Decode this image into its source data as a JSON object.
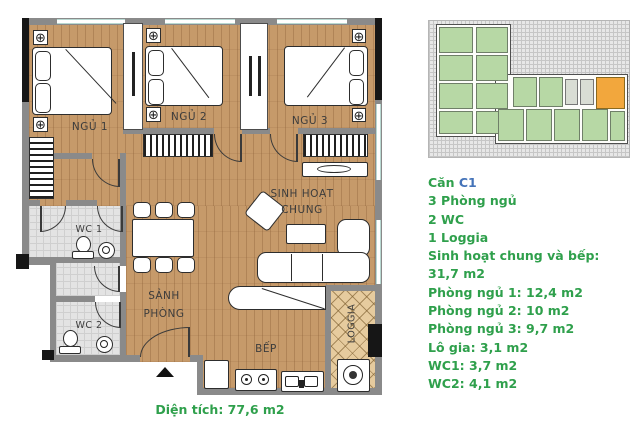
{
  "floor_plan": {
    "rooms": {
      "bedroom1": "NGỦ 1",
      "bedroom2": "NGỦ 2",
      "bedroom3": "NGỦ 3",
      "living_line1": "SINH HOẠT",
      "living_line2": "CHUNG",
      "wc1": "WC 1",
      "wc2": "WC 2",
      "hall_line1": "SẢNH",
      "hall_line2": "PHÒNG",
      "kitchen": "BẾP",
      "loggia": "LOGGIA"
    },
    "area_label": "Diện tích: 77,6 m2",
    "icons": {
      "corner_cross": "⊕"
    }
  },
  "key_plan": {
    "unit_color": "#b7d8a5",
    "highlight_color": "#f2a73d"
  },
  "info_panel": {
    "title_prefix": "Căn",
    "title_unit": "C1",
    "lines": [
      "3 Phòng ngủ",
      "2 WC",
      "1 Loggia",
      "Sinh hoạt chung và bếp:",
      "31,7 m2",
      "Phòng ngủ 1: 12,4 m2",
      "Phòng ngủ 2: 10 m2",
      "Phòng ngủ 3: 9,7 m2",
      "Lô gia: 3,1 m2",
      "WC1: 3,7 m2",
      "WC2: 4,1 m2"
    ],
    "text_color": "#2fa04c",
    "unit_text_color": "#4473b9"
  }
}
